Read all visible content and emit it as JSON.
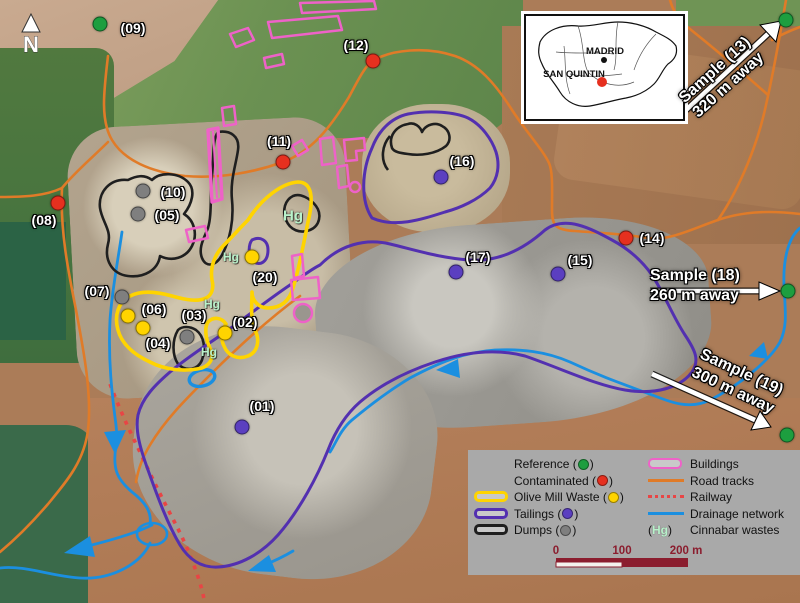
{
  "title": "San Quintin mine sampling map",
  "north_label": "N",
  "colors": {
    "reference": "#1d9e3f",
    "contaminated": "#e6301f",
    "olive_mill": "#ffd400",
    "tailings_outline": "#5330b0",
    "tailings_dot": "#5b3fc0",
    "dumps_outline": "#1f1f1f",
    "dumps_dot": "#7f7f7f",
    "buildings": "#ee62c8",
    "road": "#e07b28",
    "railway": "#e84545",
    "drainage": "#1b8fe0",
    "scalebar": "#8b1d2e",
    "hg": "#b9f2cb",
    "arrow_white": "#ffffff"
  },
  "inset": {
    "city": "MADRID",
    "site": "SAN QUINTIN"
  },
  "points": [
    {
      "id": "01",
      "label": "(01)",
      "cat": "tailings",
      "x": 242,
      "y": 427,
      "lx": 20,
      "ly": -21
    },
    {
      "id": "02",
      "label": "(02)",
      "cat": "olive",
      "x": 225,
      "y": 333,
      "lx": 20,
      "ly": -11
    },
    {
      "id": "03",
      "label": "(03)",
      "cat": "dumps",
      "x": 187,
      "y": 337,
      "lx": 7,
      "ly": -22
    },
    {
      "id": "04",
      "label": "(04)",
      "cat": "olive",
      "x": 143,
      "y": 328,
      "lx": 15,
      "ly": 15
    },
    {
      "id": "05",
      "label": "(05)",
      "cat": "dumps",
      "x": 138,
      "y": 214,
      "lx": 29,
      "ly": 1
    },
    {
      "id": "06",
      "label": "(06)",
      "cat": "olive",
      "x": 128,
      "y": 316,
      "lx": 26,
      "ly": -7
    },
    {
      "id": "07",
      "label": "(07)",
      "cat": "dumps",
      "x": 122,
      "y": 297,
      "lx": -25,
      "ly": -6
    },
    {
      "id": "08",
      "label": "(08)",
      "cat": "contaminated",
      "x": 58,
      "y": 203,
      "lx": -14,
      "ly": 17
    },
    {
      "id": "09",
      "label": "(09)",
      "cat": "reference",
      "x": 100,
      "y": 24,
      "lx": 33,
      "ly": 4
    },
    {
      "id": "10",
      "label": "(10)",
      "cat": "dumps",
      "x": 143,
      "y": 191,
      "lx": 30,
      "ly": 1
    },
    {
      "id": "11",
      "label": "(11)",
      "cat": "contaminated",
      "x": 283,
      "y": 162,
      "lx": -4,
      "ly": -21
    },
    {
      "id": "12",
      "label": "(12)",
      "cat": "contaminated",
      "x": 373,
      "y": 61,
      "lx": -17,
      "ly": -16
    },
    {
      "id": "13",
      "label": "",
      "cat": "reference",
      "x": 786,
      "y": 20,
      "lx": 0,
      "ly": 0
    },
    {
      "id": "14",
      "label": "(14)",
      "cat": "contaminated",
      "x": 626,
      "y": 238,
      "lx": 26,
      "ly": 0
    },
    {
      "id": "15",
      "label": "(15)",
      "cat": "tailings",
      "x": 558,
      "y": 274,
      "lx": 22,
      "ly": -14
    },
    {
      "id": "16",
      "label": "(16)",
      "cat": "tailings",
      "x": 441,
      "y": 177,
      "lx": 21,
      "ly": -16
    },
    {
      "id": "17",
      "label": "(17)",
      "cat": "tailings",
      "x": 456,
      "y": 272,
      "lx": 22,
      "ly": -15
    },
    {
      "id": "18",
      "label": "",
      "cat": "reference",
      "x": 788,
      "y": 291,
      "lx": 0,
      "ly": 0
    },
    {
      "id": "19",
      "label": "",
      "cat": "reference",
      "x": 787,
      "y": 435,
      "lx": 0,
      "ly": 0
    },
    {
      "id": "20",
      "label": "(20)",
      "cat": "olive",
      "x": 252,
      "y": 257,
      "lx": 13,
      "ly": 20
    }
  ],
  "hg_labels": [
    {
      "text": "Hg",
      "x": 293,
      "y": 216,
      "size": 15
    },
    {
      "text": "Hg",
      "x": 231,
      "y": 257,
      "size": 12
    },
    {
      "text": "Hg",
      "x": 212,
      "y": 304,
      "size": 12
    },
    {
      "text": "Hg",
      "x": 209,
      "y": 352,
      "size": 12
    }
  ],
  "sample_arrows": [
    {
      "label": "Sample (13)",
      "distance": "320 m away"
    },
    {
      "label": "Sample (18)",
      "distance": "260 m away"
    },
    {
      "label": "Sample (19)",
      "distance": "300 m away"
    }
  ],
  "legend": {
    "items_left": [
      {
        "label": "Reference",
        "dot": "reference",
        "swatch": ""
      },
      {
        "label": "Contaminated",
        "dot": "contaminated",
        "swatch": ""
      },
      {
        "label": "Olive Mill Waste",
        "dot": "olive_mill",
        "swatch": "olive_mill"
      },
      {
        "label": "Tailings",
        "dot": "tailings_dot",
        "swatch": "tailings_outline"
      },
      {
        "label": "Dumps",
        "dot": "dumps_dot",
        "swatch": "dumps_outline"
      }
    ],
    "items_right": [
      {
        "label": "Buildings",
        "sample": "rect",
        "color": "buildings"
      },
      {
        "label": "Road tracks",
        "sample": "line",
        "color": "road"
      },
      {
        "label": "Railway",
        "sample": "dotted",
        "color": "railway"
      },
      {
        "label": "Drainage network",
        "sample": "line",
        "color": "drainage"
      },
      {
        "label": "Cinnabar wastes",
        "sample": "hg",
        "color": "hg"
      }
    ],
    "hg_glyph": "Hg"
  },
  "scalebar": {
    "t0": "0",
    "t100": "100",
    "t200": "200 m"
  }
}
